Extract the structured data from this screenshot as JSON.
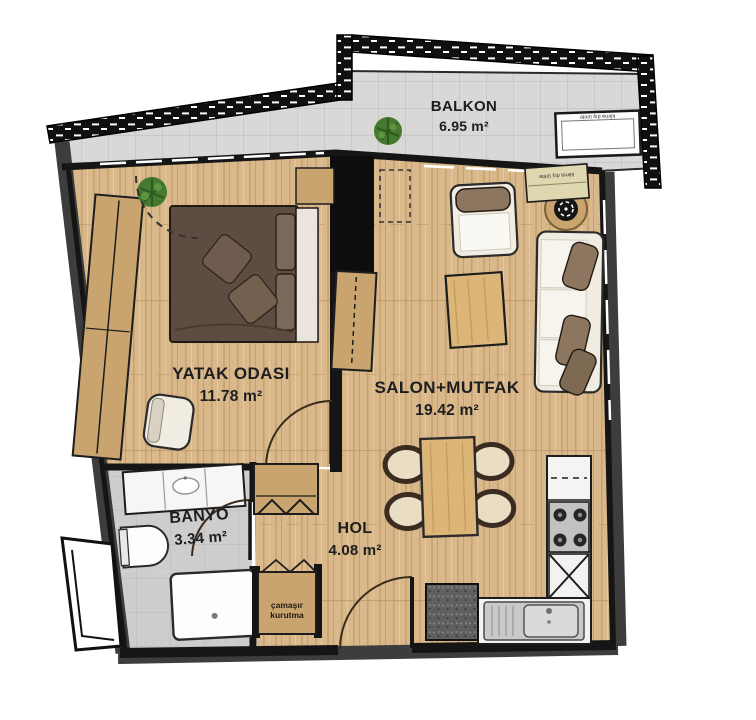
{
  "plan": {
    "rooms": [
      {
        "id": "balkon",
        "name": "BALKON",
        "area": "6.95 m²"
      },
      {
        "id": "yatak-odasi",
        "name": "YATAK ODASI",
        "area": "11.78 m²"
      },
      {
        "id": "salon-mutfak",
        "name": "SALON+MUTFAK",
        "area": "19.42 m²"
      },
      {
        "id": "banyo",
        "name": "BANYO",
        "area": "3.34 m²"
      },
      {
        "id": "hol",
        "name": "HOL",
        "area": "4.08 m²"
      }
    ],
    "annotations": {
      "laundry_line1": "çamaşır",
      "laundry_line2": "kurutma",
      "ac_unit": "klima dış ünite"
    },
    "colors": {
      "wood": "#d9b98c",
      "wood_dark": "#c9a46e",
      "wall": "#151515",
      "wall_gray": "#3d3d3d",
      "balcony_floor": "#d8d8d8",
      "bath_floor": "#cdcdcd",
      "bed": "#5d4c41",
      "cushion": "#8c7660",
      "upholstery": "#f0ece1",
      "plant": "#45792f",
      "label_text": "#1d1d1f"
    }
  }
}
